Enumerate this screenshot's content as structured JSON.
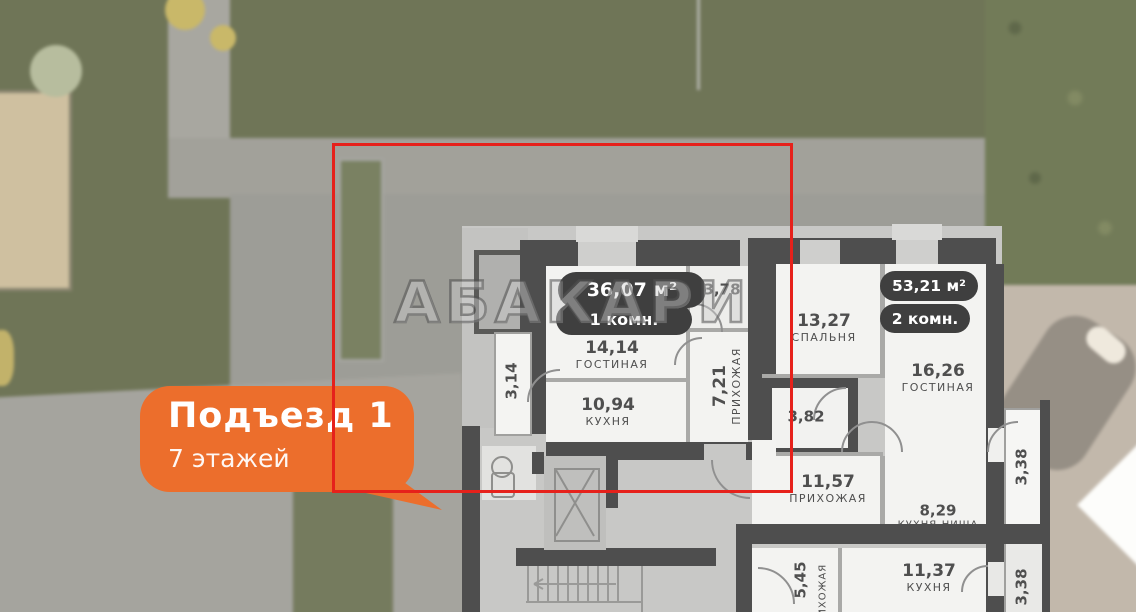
{
  "watermark": "АБАКАРИ",
  "callout": {
    "title": "Подъезд 1",
    "subtitle": "7 этажей"
  },
  "colors": {
    "selection_red": "#e6211b",
    "accent_orange": "#ec6e2c",
    "badge_dark": "#3f3f3f",
    "wall_dark": "#4e4e4e"
  },
  "apartment1": {
    "area_badge": "36,07 м²",
    "rooms_badge": "1 комн.",
    "living": {
      "area": "14,14",
      "name": "ГОСТИНАЯ"
    },
    "kitchen": {
      "area": "10,94",
      "name": "КУХНЯ"
    },
    "hall": {
      "area": "7,21",
      "name": "ПРИХОЖАЯ"
    },
    "bath": {
      "area": "3,78"
    },
    "balcony": {
      "area": "3,14"
    }
  },
  "apartment2": {
    "area_badge": "53,21 м²",
    "rooms_badge": "2 комн.",
    "bedroom": {
      "area": "13,27",
      "name": "СПАЛЬНЯ"
    },
    "living": {
      "area": "16,26",
      "name": "ГОСТИНАЯ"
    },
    "bath": {
      "area": "3,82"
    },
    "hall": {
      "area": "11,57",
      "name": "ПРИХОЖАЯ"
    },
    "kitchen_niche": {
      "area": "8,29",
      "name": "КУХНЯ-НИША"
    },
    "balcony": {
      "area": "3,38"
    }
  },
  "apartment3": {
    "hall": {
      "area": "5,45",
      "name": "ПРИХОЖАЯ"
    },
    "kitchen": {
      "area": "11,37",
      "name": "КУХНЯ"
    },
    "balcony": {
      "area": "3,38"
    }
  }
}
